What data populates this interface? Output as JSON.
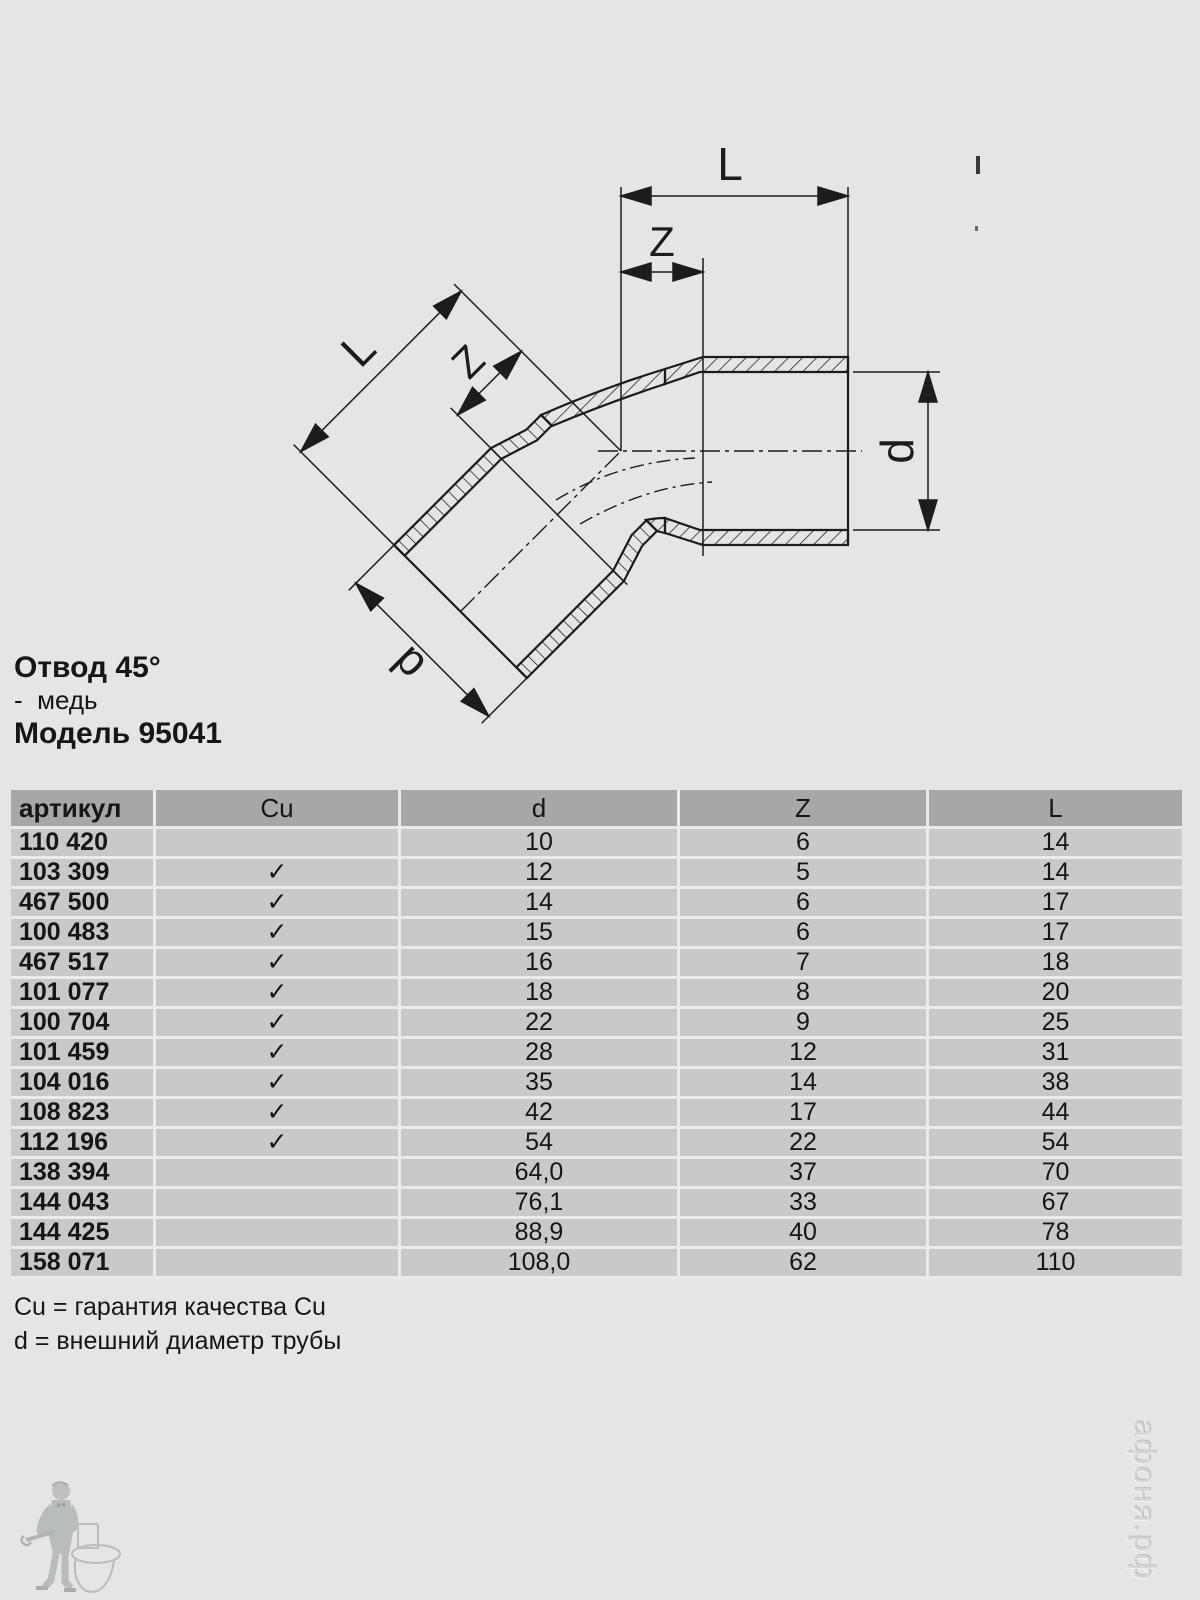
{
  "title": {
    "line1": "Отвод 45°",
    "line2": "-  медь",
    "line3": "Модель 95041"
  },
  "drawing": {
    "labels": {
      "top_l": "L",
      "top_z": "Z",
      "right_d": "d",
      "diag_l": "L",
      "diag_z": "Z",
      "diag_d": "d"
    }
  },
  "table": {
    "headers": [
      "артикул",
      "Cu",
      "d",
      "Z",
      "L"
    ],
    "rows": [
      {
        "article": "110 420",
        "cu": "",
        "d": "10",
        "z": "6",
        "l": "14"
      },
      {
        "article": "103 309",
        "cu": "✓",
        "d": "12",
        "z": "5",
        "l": "14"
      },
      {
        "article": "467 500",
        "cu": "✓",
        "d": "14",
        "z": "6",
        "l": "17"
      },
      {
        "article": "100 483",
        "cu": "✓",
        "d": "15",
        "z": "6",
        "l": "17"
      },
      {
        "article": "467 517",
        "cu": "✓",
        "d": "16",
        "z": "7",
        "l": "18"
      },
      {
        "article": "101 077",
        "cu": "✓",
        "d": "18",
        "z": "8",
        "l": "20"
      },
      {
        "article": "100 704",
        "cu": "✓",
        "d": "22",
        "z": "9",
        "l": "25"
      },
      {
        "article": "101 459",
        "cu": "✓",
        "d": "28",
        "z": "12",
        "l": "31"
      },
      {
        "article": "104 016",
        "cu": "✓",
        "d": "35",
        "z": "14",
        "l": "38"
      },
      {
        "article": "108 823",
        "cu": "✓",
        "d": "42",
        "z": "17",
        "l": "44"
      },
      {
        "article": "112 196",
        "cu": "✓",
        "d": "54",
        "z": "22",
        "l": "54"
      },
      {
        "article": "138 394",
        "cu": "",
        "d": "64,0",
        "z": "37",
        "l": "70"
      },
      {
        "article": "144 043",
        "cu": "",
        "d": "76,1",
        "z": "33",
        "l": "67"
      },
      {
        "article": "144 425",
        "cu": "",
        "d": "88,9",
        "z": "40",
        "l": "78"
      },
      {
        "article": "158 071",
        "cu": "",
        "d": "108,0",
        "z": "62",
        "l": "110"
      }
    ]
  },
  "footnotes": [
    "Cu = гарантия качества Cu",
    "d = внешний диаметр трубы"
  ],
  "watermark": "афоня.рф",
  "colors": {
    "page_bg": "#e5e5e5",
    "header_bg": "#a7a7a7",
    "row_bg": "#c9c9c9",
    "separator": "#ebebeb",
    "line": "#1c1c1c"
  }
}
